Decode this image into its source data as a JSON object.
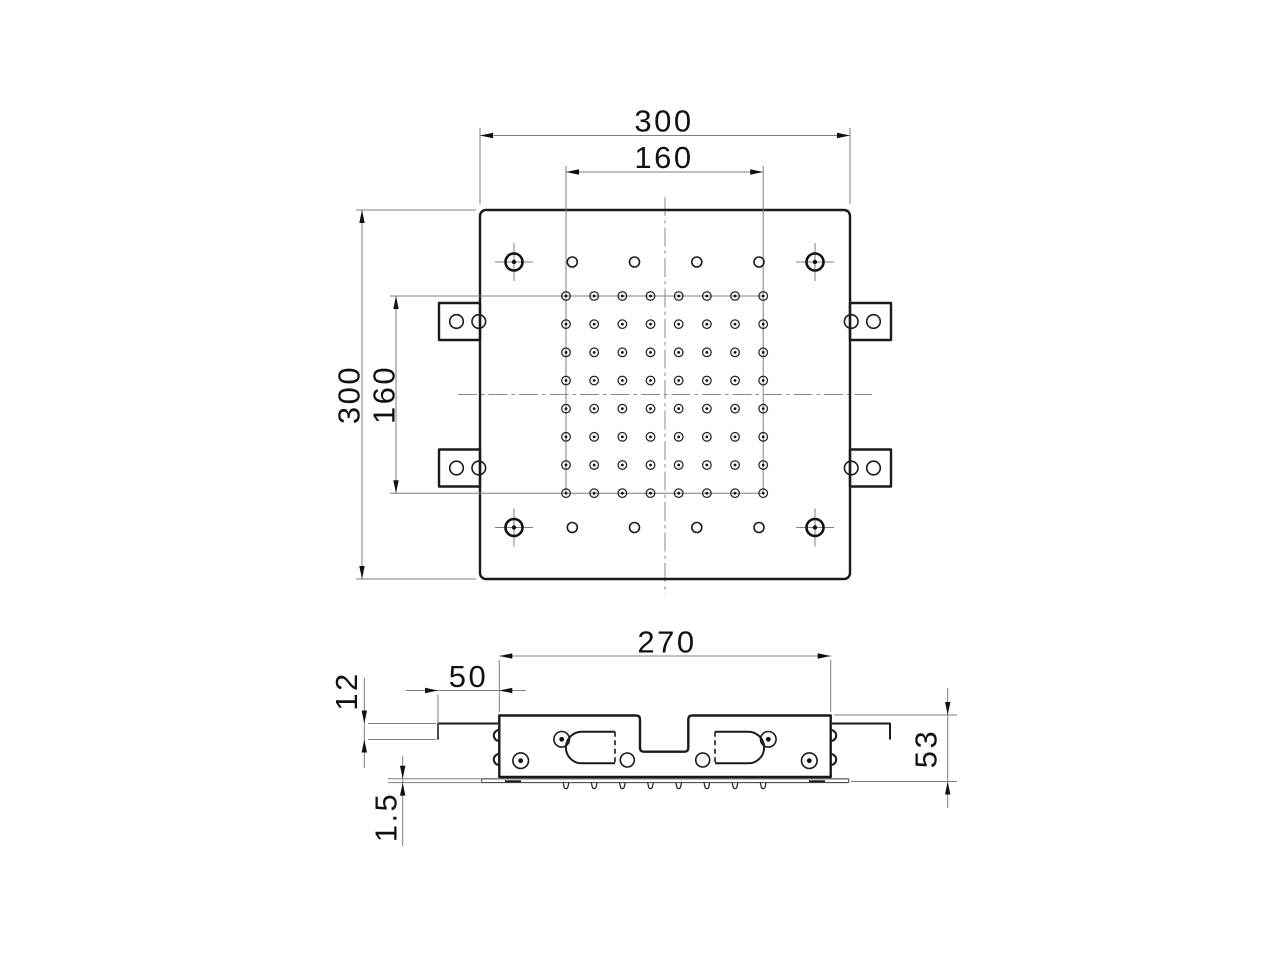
{
  "meta": {
    "background": "#ffffff",
    "ink_color": "#1a1a1a",
    "thin_line_color": "#7f7f7f",
    "drawing_type": "2-view technical drawing of square recessed shower head"
  },
  "top_view": {
    "dims": {
      "overall_width": "300",
      "overall_height": "300",
      "nozzle_field_width": "160",
      "nozzle_field_height": "160"
    },
    "nozzle_grid": {
      "rows": 8,
      "cols": 8
    },
    "edge_hole_rows": 2,
    "edge_holes_per_row": 4,
    "corner_holes": 4,
    "side_brackets": 4,
    "holes_per_bracket": 2
  },
  "side_view": {
    "dims": {
      "overall_width": "270",
      "bracket_arm_length": "50",
      "arm_drop": "12",
      "face_plate_thickness": "1.5",
      "overall_height": "53"
    },
    "nozzle_teats": 8,
    "screw_holes": 4,
    "plain_holes": 2
  }
}
